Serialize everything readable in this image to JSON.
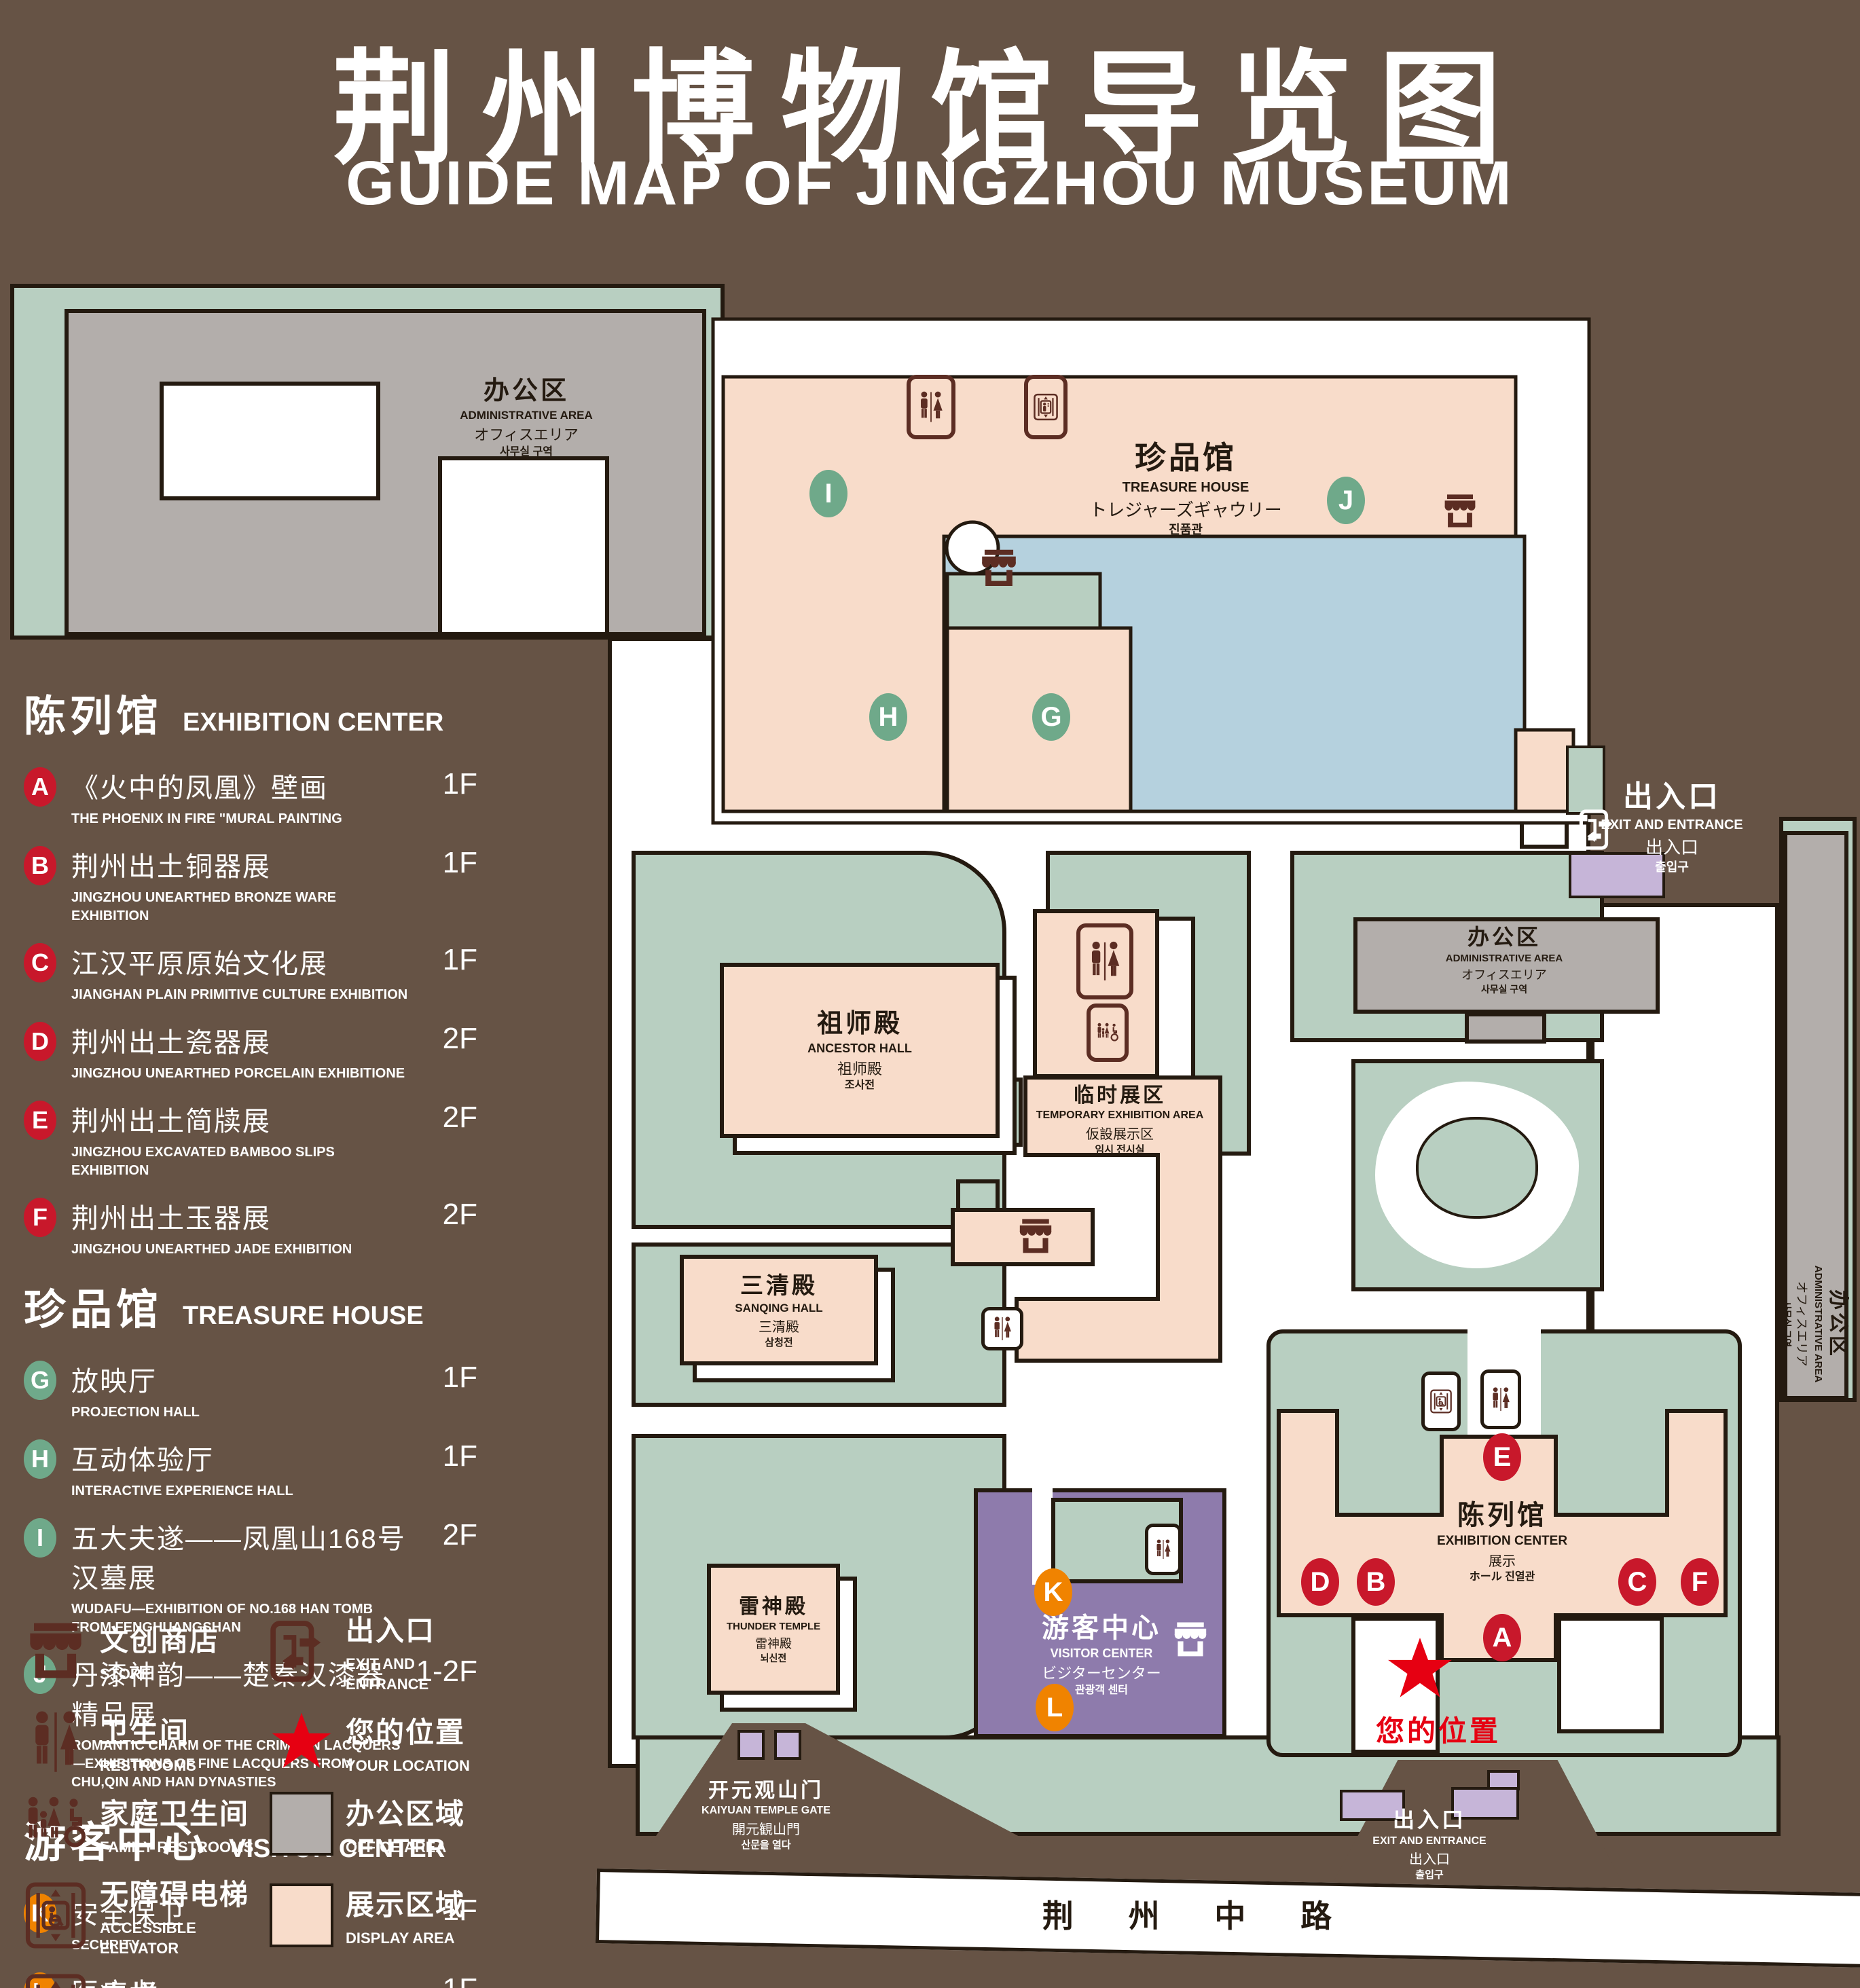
{
  "colors": {
    "background": "#665345",
    "campus_green": "#b8cfc1",
    "display_pink": "#f8dcca",
    "office_gray": "#b3aeab",
    "pond_blue": "#b5d1de",
    "visitor_purple": "#8e7bac",
    "entrance_purple": "#c6b5d8",
    "outline_dark": "#241a10",
    "badge_red": "#c8182b",
    "badge_green": "#6fa98a",
    "badge_orange": "#f08300",
    "star_red": "#e60012",
    "icon_maroon": "#5c2d23"
  },
  "title": {
    "zh": "荆州博物馆导览图",
    "en": "GUIDE MAP OF JINGZHOU MUSEUM"
  },
  "legend_sections": [
    {
      "title_zh": "陈列馆",
      "title_en": "EXHIBITION CENTER",
      "badge": "red",
      "items": [
        {
          "letter": "A",
          "zh": "《火中的凤凰》壁画",
          "en": "THE PHOENIX IN FIRE \"MURAL PAINTING",
          "floor": "1F"
        },
        {
          "letter": "B",
          "zh": "荆州出土铜器展",
          "en": "JINGZHOU UNEARTHED BRONZE WARE EXHIBITION",
          "floor": "1F"
        },
        {
          "letter": "C",
          "zh": "江汉平原原始文化展",
          "en": "JIANGHAN PLAIN PRIMITIVE CULTURE EXHIBITION",
          "floor": "1F"
        },
        {
          "letter": "D",
          "zh": "荆州出土瓷器展",
          "en": "JINGZHOU UNEARTHED PORCELAIN EXHIBITIONE",
          "floor": "2F"
        },
        {
          "letter": "E",
          "zh": "荆州出土简牍展",
          "en": "JINGZHOU EXCAVATED BAMBOO SLIPS EXHIBITION",
          "floor": "2F"
        },
        {
          "letter": "F",
          "zh": "荆州出土玉器展",
          "en": "JINGZHOU UNEARTHED JADE EXHIBITION",
          "floor": "2F"
        }
      ]
    },
    {
      "title_zh": "珍品馆",
      "title_en": "TREASURE HOUSE",
      "badge": "green",
      "items": [
        {
          "letter": "G",
          "zh": "放映厅",
          "en": "PROJECTION HALL",
          "floor": "1F"
        },
        {
          "letter": "H",
          "zh": "互动体验厅",
          "en": "INTERACTIVE EXPERIENCE HALL",
          "floor": "1F"
        },
        {
          "letter": "I",
          "zh": "五大夫遂——凤凰山168号汉墓展",
          "en": "WUDAFU—EXHIBITION OF NO.168 HAN TOMB FROM FENGHUANGSHAN",
          "floor": "2F"
        },
        {
          "letter": "J",
          "zh": "丹漆神韵——楚秦汉漆器精品展",
          "en": "ROMANTIC CHARM OF THE CRIMSON LACQUERS—EXHIBITIONS OF FINE LACQUERS FROM CHU,QIN AND HAN DYNASTIES",
          "floor": "1-2F"
        }
      ]
    },
    {
      "title_zh": "游客中心",
      "title_en": "VISITOR CENTER",
      "badge": "orange",
      "items": [
        {
          "letter": "K",
          "zh": "安全保卫",
          "en": "SECURITY",
          "floor": "1F"
        },
        {
          "letter": "L",
          "zh": "医疗点",
          "en": "CLINIC",
          "floor": "1F"
        }
      ]
    }
  ],
  "legend_icons": [
    {
      "icon": "store",
      "zh": "文创商店",
      "en": "STORE"
    },
    {
      "icon": "exit",
      "zh": "出入口",
      "en": "EXIT AND ENTRANCE"
    },
    {
      "icon": "restrooms",
      "zh": "卫生间",
      "en": "RESTROOMS"
    },
    {
      "icon": "star",
      "zh": "您的位置",
      "en": "YOUR LOCATION"
    },
    {
      "icon": "family",
      "zh": "家庭卫生间",
      "en": "FAMILY RESTROOMS"
    },
    {
      "icon": "swatch-office",
      "zh": "办公区域",
      "en": "OFFICE AREA"
    },
    {
      "icon": "accessible",
      "zh": "无障碍电梯",
      "en": "ACCESSIBLE ELEVATOR"
    },
    {
      "icon": "swatch-display",
      "zh": "展示区域",
      "en": "DISPLAY AREA"
    },
    {
      "icon": "elevator",
      "zh": "电梯",
      "en": "Elevator"
    }
  ],
  "map": {
    "admin_area": {
      "zh": "办公区",
      "en": "ADMINISTRATIVE AREA",
      "jp": "オフィスエリア",
      "kr": "사무실 구역"
    },
    "treasure_house": {
      "zh": "珍品馆",
      "en": "TREASURE HOUSE",
      "jp": "トレジャーズギャウリー",
      "kr": "진품관"
    },
    "exit": {
      "zh": "出入口",
      "en": "EXIT AND ENTRANCE",
      "jp": "出入口",
      "kr": "출입구"
    },
    "ancestor_hall": {
      "zh": "祖师殿",
      "en": "ANCESTOR HALL",
      "jp": "祖师殿",
      "kr": "조사전"
    },
    "temporary_area": {
      "zh": "临时展区",
      "en": "TEMPORARY EXHIBITION AREA",
      "jp": "仮設展示区",
      "kr": "임시 전시실"
    },
    "sanqing_hall": {
      "zh": "三清殿",
      "en": "SANQING HALL",
      "jp": "三清殿",
      "kr": "삼청전"
    },
    "thunder_temple": {
      "zh": "雷神殿",
      "en": "THUNDER TEMPLE",
      "jp": "雷神殿",
      "kr": "뇌신전"
    },
    "visitor_center": {
      "zh": "游客中心",
      "en": "VISITOR CENTER",
      "jp": "ビジターセンター",
      "kr": "관광객 센터"
    },
    "exhibition_center": {
      "zh": "陈列馆",
      "en": "EXHIBITION CENTER",
      "l3": "展示",
      "l4": "ホール 진열관"
    },
    "gate": {
      "zh": "开元观山门",
      "en": "KAIYUAN TEMPLE GATE",
      "jp": "開元観山門",
      "kr": "산문을 열다"
    },
    "your_location": "您的位置",
    "road": "荆 州 中 路",
    "markers": [
      {
        "letter": "A",
        "type": "red"
      },
      {
        "letter": "B",
        "type": "red"
      },
      {
        "letter": "C",
        "type": "red"
      },
      {
        "letter": "D",
        "type": "red"
      },
      {
        "letter": "E",
        "type": "red"
      },
      {
        "letter": "F",
        "type": "red"
      },
      {
        "letter": "G",
        "type": "green"
      },
      {
        "letter": "H",
        "type": "green"
      },
      {
        "letter": "I",
        "type": "green"
      },
      {
        "letter": "J",
        "type": "green"
      },
      {
        "letter": "K",
        "type": "orange"
      },
      {
        "letter": "L",
        "type": "orange"
      }
    ]
  }
}
